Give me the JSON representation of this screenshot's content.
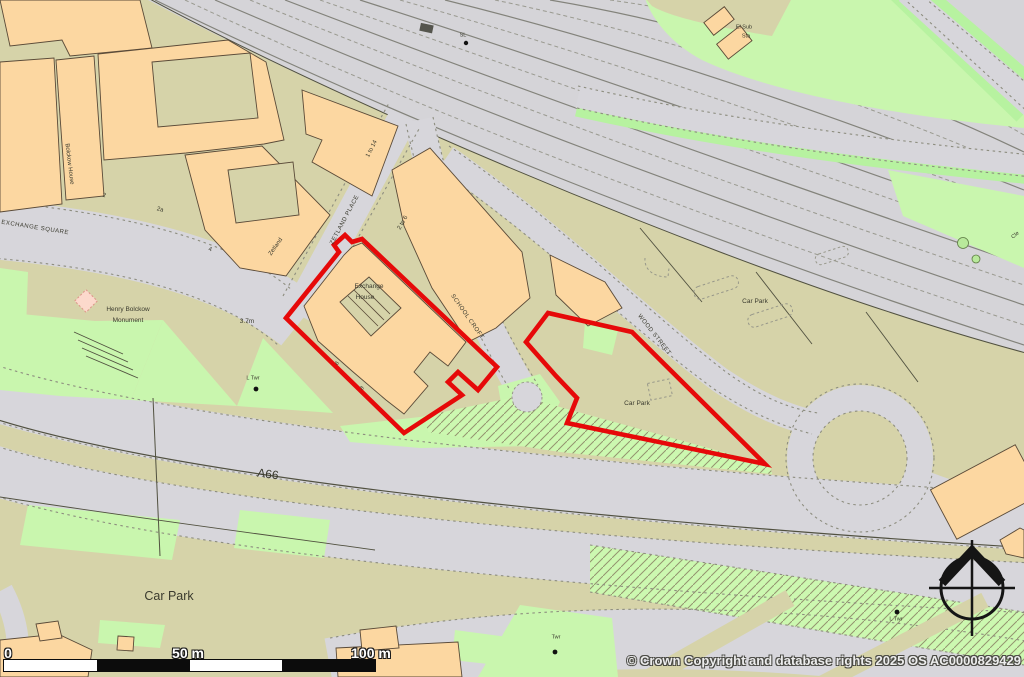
{
  "map": {
    "copyright": "© Crown Copyright and database rights 2025 OS AC0000829429",
    "scale_bar": {
      "zero": "0",
      "fifty": "50 m",
      "hundred": "100 m"
    },
    "colors": {
      "boundary_red": "#e60909",
      "building_orange": "#fcd7a1",
      "road_grey": "#d7d6db",
      "parcel_olive": "#d6d3a9",
      "grass_green": "#c9f6ae",
      "rail_grey": "#d5d4d8"
    },
    "labels": [
      {
        "name": "exchange-square-road-label",
        "text": "EXCHANGE SQUARE",
        "x": 35,
        "y": 228,
        "rot": 9,
        "fs": 6,
        "ls": 0.5
      },
      {
        "name": "henry-bolckow-monument-line1",
        "text": "Henry Bolckow",
        "x": 128,
        "y": 310,
        "rot": 0,
        "fs": 6.5
      },
      {
        "name": "henry-bolckow-monument-line2",
        "text": "Monument",
        "x": 128,
        "y": 321,
        "rot": 0,
        "fs": 6.5
      },
      {
        "name": "bolckow-house-label",
        "text": "Bolckow House",
        "x": 69,
        "y": 164,
        "rot": 83,
        "fs": 6
      },
      {
        "name": "house-number-2",
        "text": "2",
        "x": 104,
        "y": 196,
        "rot": 15,
        "fs": 6
      },
      {
        "name": "house-number-2a",
        "text": "2a",
        "x": 160,
        "y": 210,
        "rot": 15,
        "fs": 6
      },
      {
        "name": "house-number-4",
        "text": "4",
        "x": 210,
        "y": 250,
        "rot": 15,
        "fs": 6
      },
      {
        "name": "zetland-building-label",
        "text": "Zetland",
        "x": 276,
        "y": 247,
        "rot": -55,
        "fs": 6
      },
      {
        "name": "zetland-place-street-label",
        "text": "ZETLAND PLACE",
        "x": 345,
        "y": 220,
        "rot": -62,
        "fs": 6,
        "ls": 0.5
      },
      {
        "name": "building-1-to-14-label",
        "text": "1 to 14",
        "x": 372,
        "y": 149,
        "rot": -63,
        "fs": 6
      },
      {
        "name": "building-2-to-6-label",
        "text": "2 to 6",
        "x": 403,
        "y": 223,
        "rot": -60,
        "fs": 6
      },
      {
        "name": "exchange-house-label-line1",
        "text": "Exchange",
        "x": 369,
        "y": 287,
        "rot": 0,
        "fs": 6.5
      },
      {
        "name": "exchange-house-label-line2",
        "text": "House",
        "x": 365,
        "y": 298,
        "rot": 0,
        "fs": 6.5
      },
      {
        "name": "house-number-6",
        "text": "6",
        "x": 338,
        "y": 364,
        "rot": -50,
        "fs": 5.5,
        "it": 1
      },
      {
        "name": "house-number-8",
        "text": "8",
        "x": 363,
        "y": 389,
        "rot": -50,
        "fs": 5.5,
        "it": 1
      },
      {
        "name": "school-croft-street-label",
        "text": "SCHOOL CROFT",
        "x": 467,
        "y": 317,
        "rot": 55,
        "fs": 6,
        "ls": 0.5
      },
      {
        "name": "wood-street-street-label",
        "text": "WOOD STREET",
        "x": 654,
        "y": 335,
        "rot": 52,
        "fs": 6,
        "ls": 0.5
      },
      {
        "name": "car-park-label-northeast",
        "text": "Car Park",
        "x": 755,
        "y": 302,
        "rot": 0,
        "fs": 6.5
      },
      {
        "name": "car-park-label-site",
        "text": "Car Park",
        "x": 637,
        "y": 404,
        "rot": 0,
        "fs": 6.5
      },
      {
        "name": "spot-height-label",
        "text": "3.7m",
        "x": 247,
        "y": 322,
        "rot": 0,
        "fs": 6.5
      },
      {
        "name": "lighting-tower-label-1",
        "text": "L Twr",
        "x": 253,
        "y": 379,
        "rot": 0,
        "fs": 5.5
      },
      {
        "name": "a66-road-label",
        "text": "A66",
        "x": 268,
        "y": 474,
        "rot": 8,
        "fs": 12
      },
      {
        "name": "car-park-label-southwest",
        "text": "Car Park",
        "x": 169,
        "y": 596,
        "rot": 0,
        "fs": 12.5
      },
      {
        "name": "tower-label",
        "text": "Twr",
        "x": 556,
        "y": 638,
        "rot": 0,
        "fs": 5.5
      },
      {
        "name": "lighting-tower-label-2",
        "text": "L Twr",
        "x": 896,
        "y": 620,
        "rot": 0,
        "fs": 5.5
      },
      {
        "name": "signal-label",
        "text": "SL",
        "x": 463,
        "y": 36,
        "rot": 0,
        "fs": 5.5
      },
      {
        "name": "el-sub-sta-label-line1",
        "text": "El Sub",
        "x": 744,
        "y": 28,
        "rot": 0,
        "fs": 5.5
      },
      {
        "name": "el-sub-sta-label-line2",
        "text": "Sta",
        "x": 746,
        "y": 37,
        "rot": 0,
        "fs": 5.5
      },
      {
        "name": "street-partial-right-edge",
        "text": "Cle",
        "x": 1016,
        "y": 236,
        "rot": -40,
        "fs": 5.5
      }
    ]
  }
}
